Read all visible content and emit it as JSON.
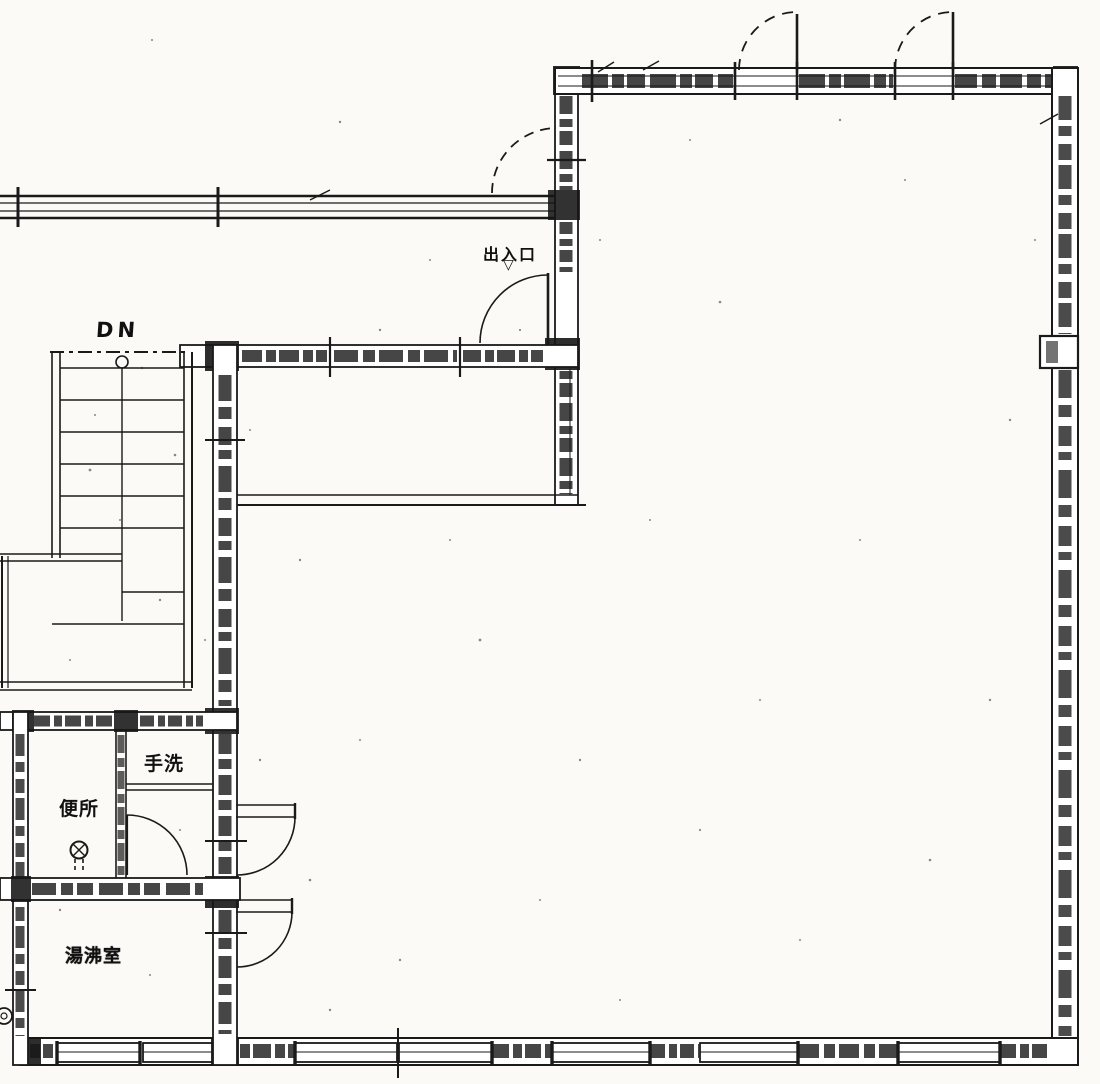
{
  "drawing": {
    "type": "architectural floor plan (scanned)",
    "ink_color": "#1a1a1a",
    "paper_color": "#fbfaf6"
  },
  "labels": {
    "stair_direction": "DN",
    "entrance": "出入口",
    "entrance_marker": "▽",
    "hand_wash": "手洗",
    "toilet": "便所",
    "hot_water_room": "湯沸室"
  }
}
